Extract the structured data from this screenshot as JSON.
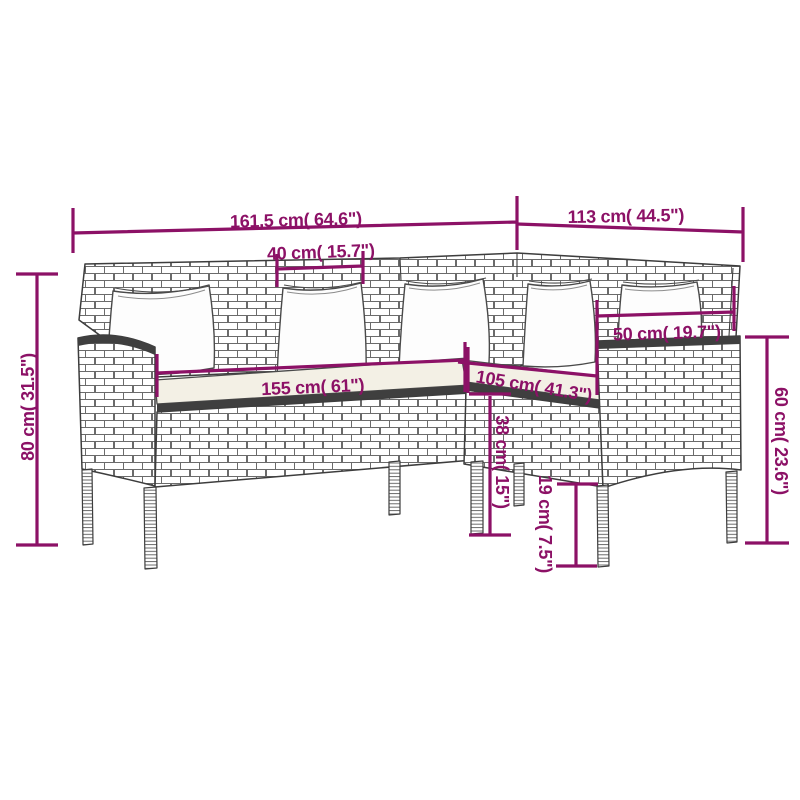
{
  "colors": {
    "background": "#ffffff",
    "dimension_accent": "#8C1166",
    "line_art": "#3d3d3d",
    "dark_band": "#3f3f3f",
    "seat_cushion": "#f3f0e5",
    "pillow": "#fdfdfd"
  },
  "diagram": {
    "depicts": "L-shaped rattan sofa with 5 back pillows and seat cushions, annotated dimension drawing",
    "dims": {
      "width_left": "161,5 cm( 64.6\")",
      "width_right": "113 cm( 44.5\")",
      "back_segment": "40 cm( 15.7\")",
      "height_total": "80 cm( 31.5\")",
      "height_right": "60 cm( 23.6\")",
      "pillow": "50 cm( 19.7\")",
      "seat_left": "155 cm( 61\")",
      "seat_right": "105 cm( 41.3\")",
      "seat_height": "38 cm( 15\")",
      "leg_height": "19 cm( 7.5\")"
    }
  }
}
